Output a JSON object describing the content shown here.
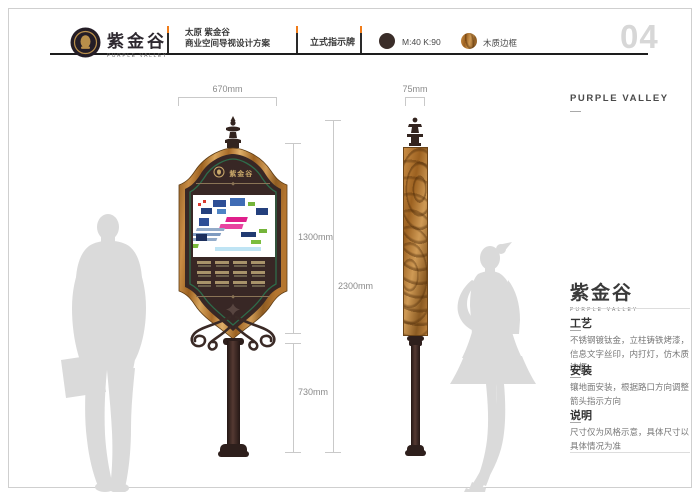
{
  "header": {
    "brand": {
      "name_cn": "紫金谷",
      "name_en": "PURPLE VALLEY"
    },
    "project_line1": "太原 紫金谷",
    "project_line2": "商业空间导视设计方案",
    "sheet_title": "立式指示牌",
    "legend": [
      {
        "label": "M:40 K:90",
        "color": "#3a2d29",
        "swatch": "dark-circle"
      },
      {
        "label": "木质边框",
        "color": "#c07a3e",
        "swatch": "wood-circle"
      }
    ],
    "page_number": "04",
    "accent_color": "#f07c1a"
  },
  "drawing": {
    "front_view": {
      "width_dim": "670mm",
      "sign_height_dim": "1300mm",
      "total_height_dim": "2300mm",
      "pole_height_dim": "730mm",
      "emblem_text": "紫金谷",
      "directory": {
        "rows": 3,
        "cols": 4
      }
    },
    "side_view": {
      "width_dim": "75mm"
    },
    "map_blocks": [
      {
        "x": 20,
        "y": 5,
        "w": 13,
        "h": 7,
        "fill": "#2e4f96"
      },
      {
        "x": 37,
        "y": 3,
        "w": 15,
        "h": 8,
        "fill": "#3f6cb5"
      },
      {
        "x": 55,
        "y": 7,
        "w": 7,
        "h": 4,
        "fill": "#74b43a"
      },
      {
        "x": 8,
        "y": 13,
        "w": 11,
        "h": 6,
        "fill": "#24407d"
      },
      {
        "x": 24,
        "y": 14,
        "w": 9,
        "h": 5,
        "fill": "#4e84c4"
      },
      {
        "x": 63,
        "y": 13,
        "w": 12,
        "h": 7,
        "fill": "#24407d"
      },
      {
        "x": 5,
        "y": 8,
        "w": 3,
        "h": 3,
        "fill": "#d93a30"
      },
      {
        "x": 10,
        "y": 5,
        "w": 3,
        "h": 3,
        "fill": "#d93a30"
      },
      {
        "x": 41,
        "y": 22,
        "w": 21,
        "h": 5,
        "fill": "#df1f8b",
        "tf": "skewX(-18)"
      },
      {
        "x": 37,
        "y": 29,
        "w": 23,
        "h": 5,
        "fill": "#e843a0",
        "tf": "skewX(-18)"
      },
      {
        "x": 6,
        "y": 23,
        "w": 10,
        "h": 8,
        "fill": "#2e4f96"
      },
      {
        "x": 16,
        "y": 33,
        "w": 28,
        "h": 3,
        "fill": "#93abc9",
        "tf": "skewX(-20)"
      },
      {
        "x": 14,
        "y": 38,
        "w": 28,
        "h": 3,
        "fill": "#7f9bc0",
        "tf": "skewX(-20)"
      },
      {
        "x": 12,
        "y": 43,
        "w": 28,
        "h": 3,
        "fill": "#93abc9",
        "tf": "skewX(-20)"
      },
      {
        "x": 3,
        "y": 39,
        "w": 11,
        "h": 7,
        "fill": "#1c2f5c"
      },
      {
        "x": 48,
        "y": 37,
        "w": 15,
        "h": 5,
        "fill": "#203a72"
      },
      {
        "x": 66,
        "y": 34,
        "w": 8,
        "h": 4,
        "fill": "#74b43a"
      },
      {
        "x": 2,
        "y": 49,
        "w": 17,
        "h": 4,
        "fill": "#7bbd3e",
        "tf": "skewX(-15)"
      },
      {
        "x": 22,
        "y": 52,
        "w": 46,
        "h": 4,
        "fill": "#bfe4f4"
      },
      {
        "x": 58,
        "y": 45,
        "w": 10,
        "h": 4,
        "fill": "#7bbd3e"
      }
    ]
  },
  "side_panel": {
    "top_label": "PURPLE VALLEY",
    "brand_cn": "紫金谷",
    "brand_en": "PURPLE VALLEY",
    "sections": [
      {
        "heading": "工艺",
        "body": "不锈钢镀钛金，立柱铸铁烤漆，信息文字丝印，内打灯，仿木质边框"
      },
      {
        "heading": "安装",
        "body": "镶地面安装，根据路口方向调整箭头指示方向"
      },
      {
        "heading": "说明",
        "body": "尺寸仅为风格示意，具体尺寸以具体情况为准"
      }
    ]
  },
  "colors": {
    "sign_body": "#382725",
    "wood": "#b5762f",
    "pinstripe_green": "#2e6b4a",
    "gold": "#a8905e",
    "silhouette": "#dadada"
  }
}
